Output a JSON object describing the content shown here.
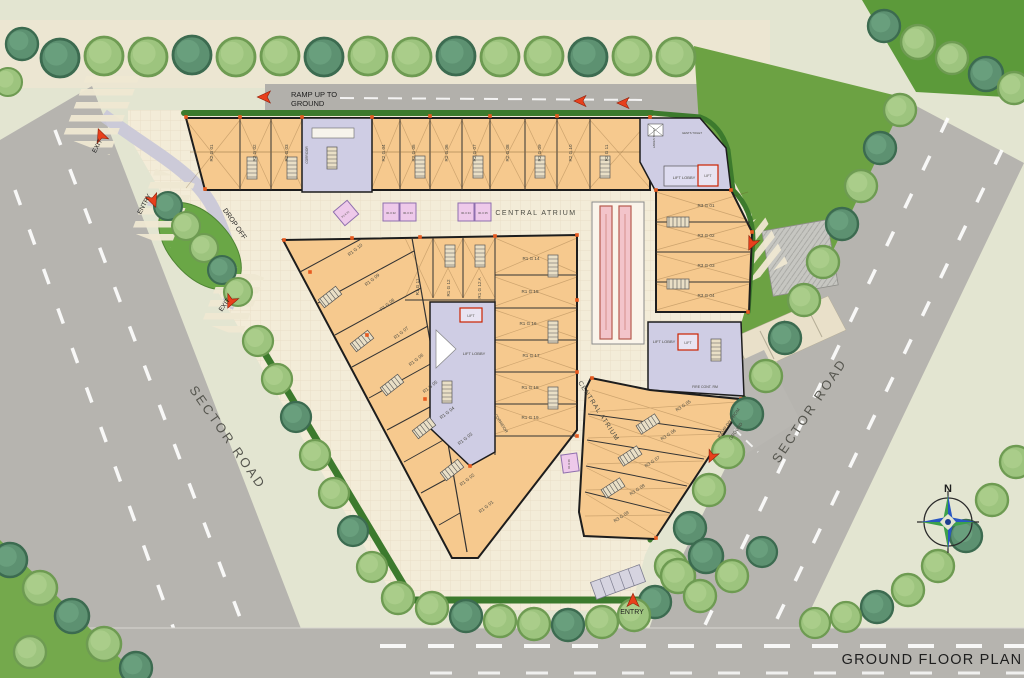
{
  "plan": {
    "title": "GROUND FLOOR PLAN",
    "north": "N",
    "road_left": "SECTOR ROAD",
    "road_right": "SECTOR ROAD",
    "ramp_up_line1": "RAMP UP TO",
    "ramp_up_line2": "GROUND",
    "ramp_dn_line1": "RAMP DN FROM",
    "ramp_dn_line2": "GROUND",
    "drop_off": "DROP OFF",
    "exit": "EXIT",
    "entry": "ENTRY",
    "central_atrium": "CENTRAL ATRIUM",
    "corridor": "CORRIDOR",
    "lift_lobby": "LIFT LOBBY",
    "lift": "LIFT",
    "fire_room": "FIRE CONT. RM",
    "toilet_gents": "GENTS TOILET",
    "toilet_ladies": "LADIES TOILET"
  },
  "units": {
    "r2": [
      "R2 G 01",
      "R2 G 02",
      "R2 G 03",
      "R2 G 04",
      "R2 G 05",
      "R2 G 06",
      "R2 G 07",
      "R2 G 08",
      "R2 G 09",
      "R2 G 10",
      "R2 G 11"
    ],
    "r1_left": [
      "R1 G 10",
      "R1 G 09",
      "R1 G 08",
      "R1 G 07",
      "R1 G 06",
      "R1 G 05",
      "R1 G 04",
      "R1 G 03",
      "R1 G 02",
      "R1 G 01"
    ],
    "r1_mid": [
      "R1 G 11",
      "R1 G 12",
      "R1 G 12 A"
    ],
    "r1_right": [
      "R1 G 14",
      "R1 G 15",
      "R1 G 16",
      "R1 G 17",
      "R1 G 18",
      "R1 G 19"
    ],
    "r3_upper": [
      "R3 G 01",
      "R3 G 02",
      "R3 G 03",
      "R3 G 04"
    ],
    "r3_lower": [
      "R3 G 05",
      "R3 G 06",
      "R3 G 07",
      "R3 G 08",
      "R3 G 09"
    ],
    "kiosks": [
      "R1 K 01",
      "R1 K 02",
      "R1 K 03",
      "R1 K 04",
      "R1 K 05",
      "R1 K 06"
    ]
  },
  "colors": {
    "shop_fill": "#f6c98e",
    "service_fill": "#cfcde4",
    "kiosk_fill": "#eec9ea",
    "road": "#b6b4af",
    "lawn": "#6ca243",
    "plaza": "#f3ecd8",
    "hedge": "#3c7a2d",
    "accent_red": "#e8401c"
  }
}
